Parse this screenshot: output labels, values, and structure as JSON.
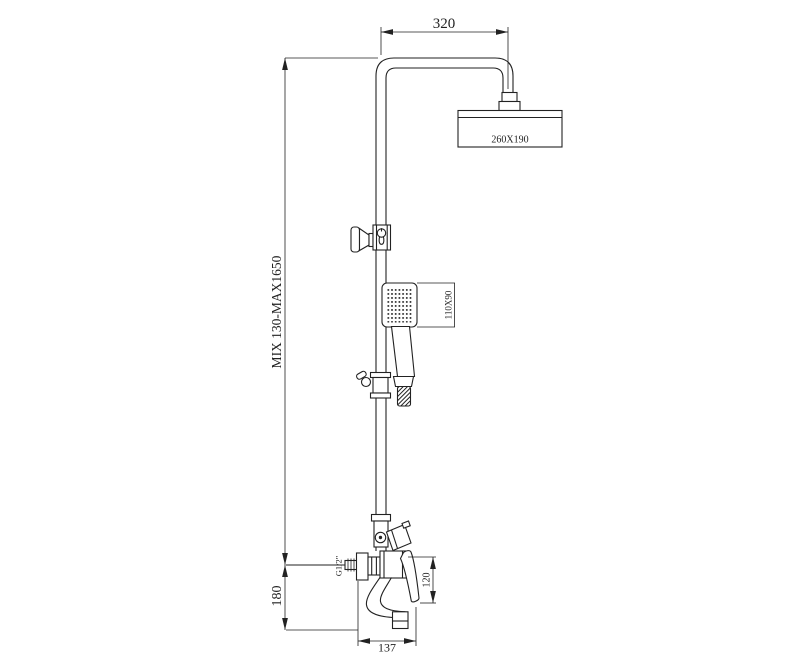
{
  "drawing": {
    "dimensions": {
      "arm_length": "320",
      "head_size": "260X190",
      "height_range": "MIX 130-MAX1650",
      "handshower_size": "110X90",
      "spout_drop": "180",
      "connection_thread": "G1/2\"",
      "body_height": "120",
      "spout_reach": "137"
    },
    "colors": {
      "line": "#222222",
      "background": "#ffffff"
    }
  }
}
